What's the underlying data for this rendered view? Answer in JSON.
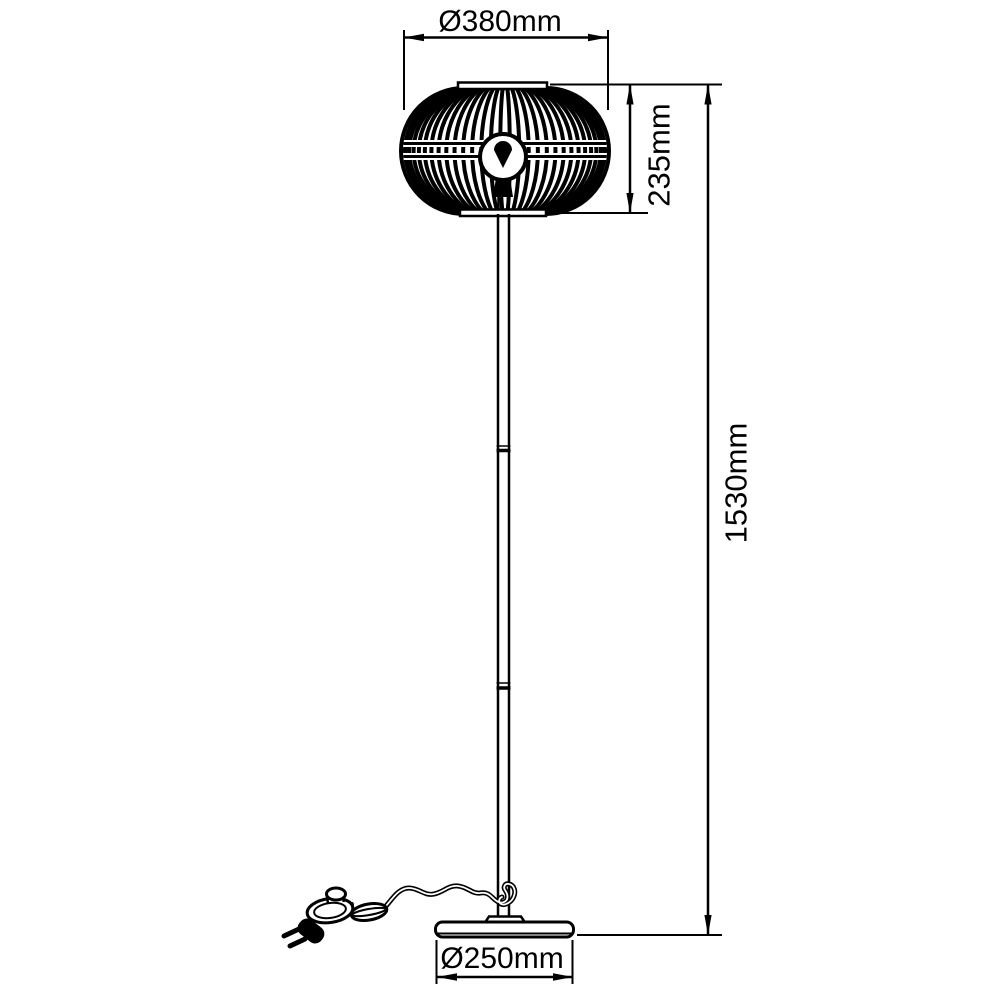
{
  "colors": {
    "background": "#ffffff",
    "line": "#000000"
  },
  "dimensions": {
    "shade_diameter": "Ø380mm",
    "shade_height": "235mm",
    "total_height": "1530mm",
    "base_diameter": "Ø250mm"
  }
}
